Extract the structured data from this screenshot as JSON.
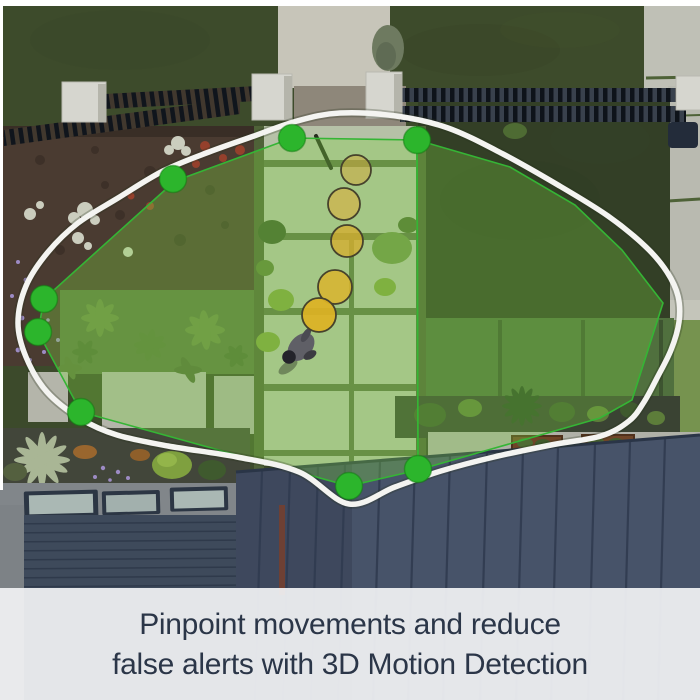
{
  "image": {
    "description": "Aerial top-down view of a backyard: lawns, garden beds, central paver walkway, pergola benches, house roof; a person walks along the walkway",
    "caption": {
      "line1": "Pinpoint movements and reduce",
      "line2": "false alerts with 3D Motion Detection"
    },
    "overlay": {
      "detection_outline": "white rounded boundary curve",
      "zones": 2,
      "zone_vertex_dots": 8,
      "motion_trail_points": 5,
      "person_present": true
    },
    "colors": {
      "zone_outline_green": "#35b535",
      "vertex_dot_green": "#2cb52c",
      "zone_fill_green": "#7ed342",
      "trail_yellow": "#d9ad2c",
      "outline_white": "#f4f4f1",
      "caption_bg": "#eceef0",
      "caption_text": "#2b3648",
      "roof_slate": "#475369"
    }
  }
}
